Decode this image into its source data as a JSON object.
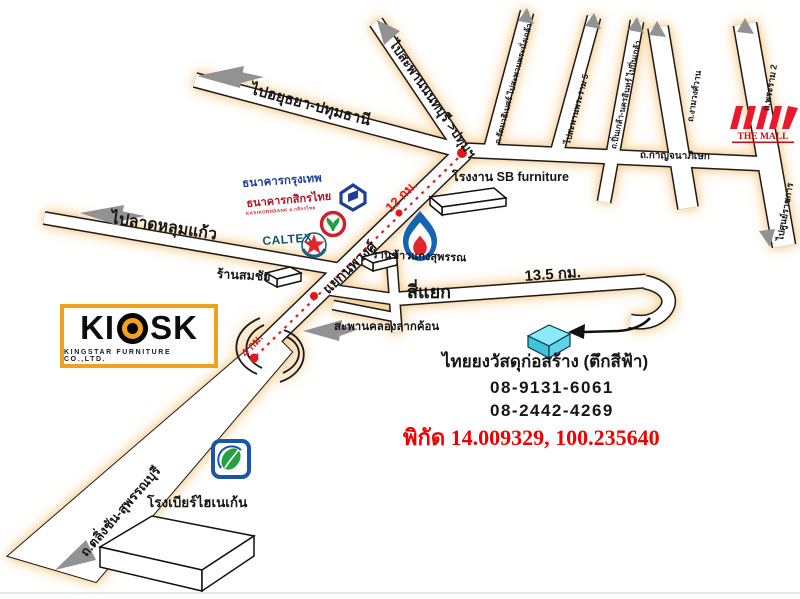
{
  "map": {
    "roads": {
      "ayutthaya": "ไปอยุธยา-ปทุมธานี",
      "nonthaburi_bridge": "ไปสะพานนนทบุรี >ปทุมฯ",
      "rattanathibet": "ถ.รัตนาธิเบศร์ ไปสะพานพระนั่งเกล้า",
      "rama5": "ไปสะพานพระราม 5",
      "pinklao": "ถ.ปิ่นเกล้า-นครอินทร์ ไปปิ่นเกล้า",
      "ngamwongwan": "ถ.งามวงศ์วาน",
      "rama2": "ถ.พระราม 2",
      "government_complex": "ไปศูนย์ราชการ",
      "kanchanaphisek": "ถ.กาญจนาภิเษก",
      "lat_lum_kaeo": "ไปลาดหลุมแก้ว",
      "nopphawong": "แยกนพวงศ์",
      "si_yaek": "สี่แยก",
      "bridge": "สะพานคลองลากค้อน",
      "taling_chan": "ถ.ตลิ่งชัน-สุพรรณบุรี"
    },
    "places": {
      "sb_factory": "โรงงาน SB furniture",
      "rice_shop": "ร้านข้าวแกงสุพรรณ",
      "somchai_shop": "ร้านสมชัย",
      "heineken": "โรงเบียร์ไฮเนเก้น",
      "thaiyong": "ไทยยงวัสดุก่อสร้าง (ตึกสีฟ้า)"
    },
    "distances": {
      "d12": "12 กม.",
      "d4": "4 กม.",
      "d135": "13.5 กม."
    },
    "contact": {
      "phone1": "08-9131-6061",
      "phone2": "08-2442-4269",
      "coordinates": "พิกัด 14.009329, 100.235640"
    },
    "logos": {
      "kiosk": "KI",
      "kiosk2": "SK",
      "kiosk_sub": "KINGSTAR FURNITURE CO.,LTD.",
      "bbl": "ธนาคารกรุงเทพ",
      "kbank": "ธนาคารกสิกรไทย",
      "kbank_sub": "KASIKORNBANK ธ.กสิกรไทย",
      "caltex": "CALTEX",
      "the_mall": "THE MALL"
    },
    "colors": {
      "accent_red": "#e01820",
      "road_glow": "#f6c98f",
      "cyan_building": "#8be9f8",
      "kiosk_orange": "#f0a21e"
    }
  }
}
